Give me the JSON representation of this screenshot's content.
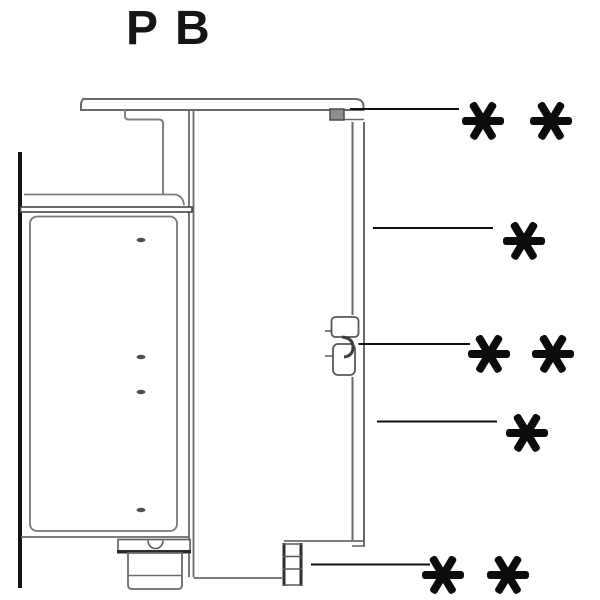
{
  "title": "PB",
  "diagram": {
    "kind": "cabinet-side-panel-section",
    "background_color": "#ffffff",
    "line_color": "#6a6a6a",
    "dark_line_color": "#2f2f2f",
    "wall_color": "#141414",
    "mark_color": "#0c0c0c",
    "shelf_pin_dots": 4
  },
  "annotations": [
    {
      "id": "countertop-fixing",
      "symbol": "✱ ✱",
      "marks": 2
    },
    {
      "id": "side-panel-upper",
      "symbol": "✱",
      "marks": 1
    },
    {
      "id": "panel-connector",
      "symbol": "✱ ✱",
      "marks": 2
    },
    {
      "id": "side-panel-lower",
      "symbol": "✱",
      "marks": 1
    },
    {
      "id": "base-fixing",
      "symbol": "✱ ✱",
      "marks": 2
    }
  ]
}
